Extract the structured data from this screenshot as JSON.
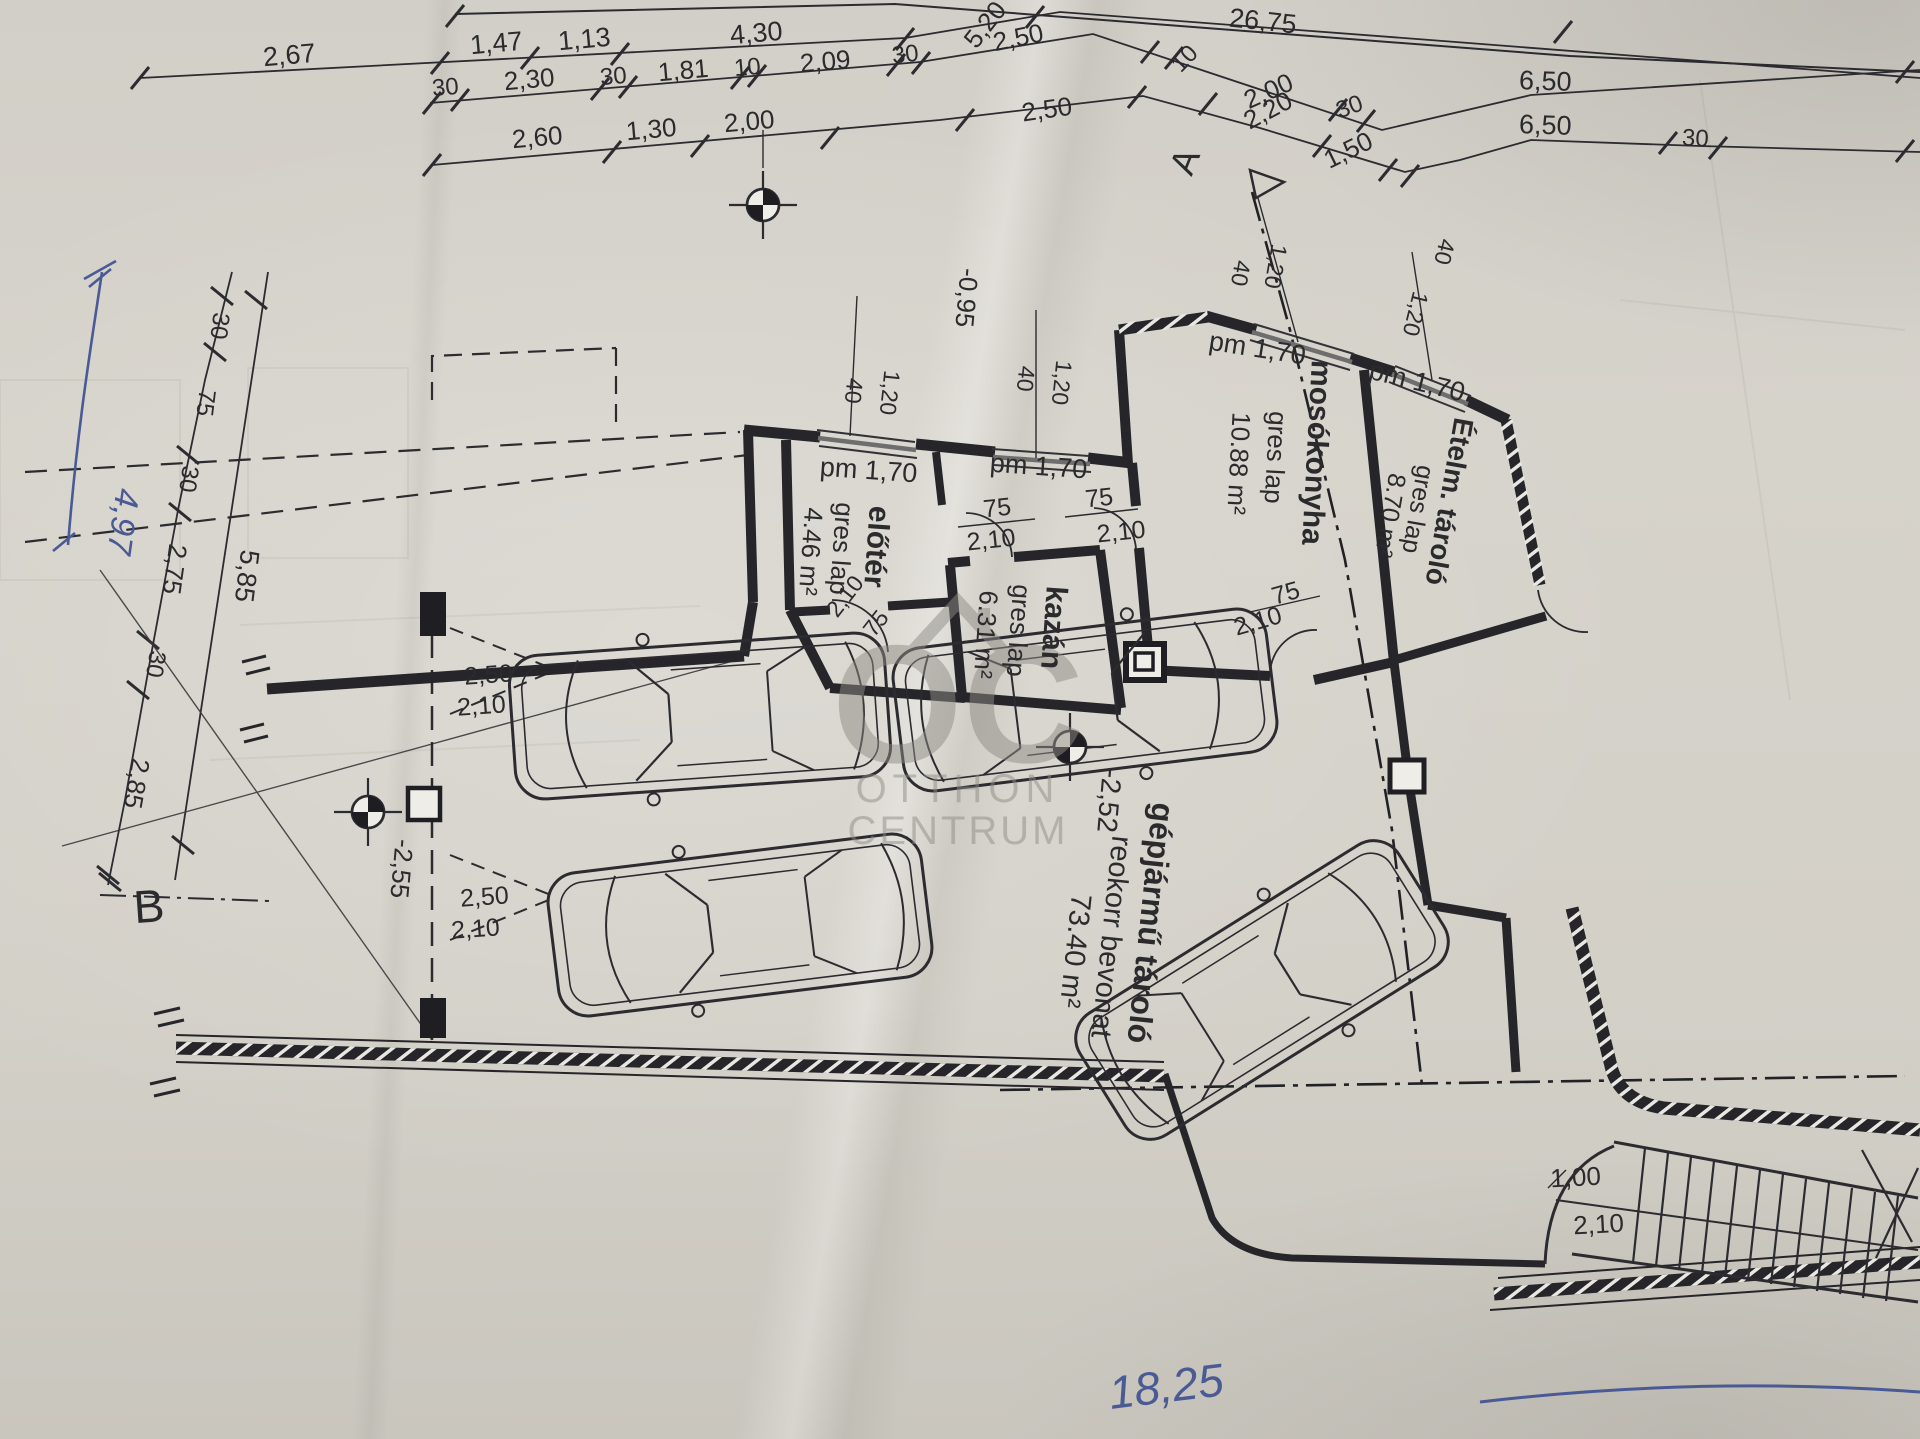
{
  "colors": {
    "ink": "#2b2b2e",
    "pen": "#4a5a95",
    "watermark": "#8e8c85",
    "paper": "#d4d1ca",
    "wall": "#26262a",
    "window_center": "#6e6e6e"
  },
  "watermark": {
    "logo": "OC",
    "name_line1": "OTTHON",
    "name_line2": "CENTRUM"
  },
  "rooms": [
    {
      "name": "előtér",
      "finish": "gres lap",
      "area": "4.46 m²"
    },
    {
      "name": "mosókonyha",
      "finish": "gres lap",
      "area": "10.88 m²"
    },
    {
      "name": "Ételm. tároló",
      "finish": "gres lap",
      "area": "8.70 m²"
    },
    {
      "name": "kazán",
      "finish": "gres lap",
      "area": "6.31 m²"
    },
    {
      "name": "gépjármű tároló",
      "finish": "reokorr bevonat",
      "area": "73.40 m²"
    }
  ],
  "elevation_markers": [
    "-0,95",
    "-2,52",
    "-2,55"
  ],
  "section_markers": [
    "A",
    "B"
  ],
  "stair_dims": [
    "1,00",
    "2,10"
  ],
  "handwritten_notes": [
    "4,97",
    "18,25"
  ],
  "window_labels": [
    "pm 1,70",
    "40",
    "1,20"
  ],
  "door_size_labels": [
    "75",
    "2,10",
    "2,50"
  ],
  "labels": [
    {
      "t": "2,67",
      "x": 290,
      "y": 64,
      "r": -5,
      "s": 27
    },
    {
      "t": "1,47",
      "x": 497,
      "y": 52,
      "r": -5,
      "s": 27
    },
    {
      "t": "1,13",
      "x": 585,
      "y": 48,
      "r": -5,
      "s": 27
    },
    {
      "t": "4,30",
      "x": 757,
      "y": 42,
      "r": -5,
      "s": 27
    },
    {
      "t": "5,20",
      "x": 992,
      "y": 30,
      "r": -52,
      "s": 26
    },
    {
      "t": "26,75",
      "x": 1262,
      "y": 30,
      "r": 6,
      "s": 27
    },
    {
      "t": "30",
      "x": 446,
      "y": 95,
      "r": -5,
      "s": 24
    },
    {
      "t": "2,30",
      "x": 530,
      "y": 88,
      "r": -5,
      "s": 26
    },
    {
      "t": "30",
      "x": 614,
      "y": 84,
      "r": -5,
      "s": 24
    },
    {
      "t": "1,81",
      "x": 684,
      "y": 79,
      "r": -5,
      "s": 26
    },
    {
      "t": "10",
      "x": 748,
      "y": 75,
      "r": -5,
      "s": 24
    },
    {
      "t": "2,09",
      "x": 826,
      "y": 70,
      "r": -5,
      "s": 26
    },
    {
      "t": "30",
      "x": 906,
      "y": 62,
      "r": -6,
      "s": 24
    },
    {
      "t": "2,50",
      "x": 1020,
      "y": 46,
      "r": -12,
      "s": 26
    },
    {
      "t": "10",
      "x": 1190,
      "y": 64,
      "r": -46,
      "s": 24
    },
    {
      "t": "2,00",
      "x": 1272,
      "y": 99,
      "r": -24,
      "s": 26
    },
    {
      "t": "30",
      "x": 1352,
      "y": 114,
      "r": -20,
      "s": 24
    },
    {
      "t": "6,50",
      "x": 1545,
      "y": 90,
      "r": 2,
      "s": 27
    },
    {
      "t": "2,60",
      "x": 538,
      "y": 146,
      "r": -5,
      "s": 26
    },
    {
      "t": "1,30",
      "x": 652,
      "y": 138,
      "r": -5,
      "s": 26
    },
    {
      "t": "2,00",
      "x": 750,
      "y": 130,
      "r": -5,
      "s": 26
    },
    {
      "t": "2,50",
      "x": 1048,
      "y": 118,
      "r": -8,
      "s": 26
    },
    {
      "t": "2,20",
      "x": 1272,
      "y": 118,
      "r": -28,
      "s": 26
    },
    {
      "t": "1,50",
      "x": 1352,
      "y": 158,
      "r": -26,
      "s": 26
    },
    {
      "t": "6,50",
      "x": 1545,
      "y": 134,
      "r": 2,
      "s": 27
    },
    {
      "t": "30",
      "x": 1695,
      "y": 146,
      "r": 3,
      "s": 24
    },
    {
      "t": "A",
      "x": 1196,
      "y": 166,
      "r": -68,
      "s": 36
    },
    {
      "t": "30",
      "x": 212,
      "y": 325,
      "r": 97,
      "s": 24
    },
    {
      "t": "75",
      "x": 198,
      "y": 402,
      "r": 97,
      "s": 24
    },
    {
      "t": "30",
      "x": 181,
      "y": 478,
      "r": 98,
      "s": 24
    },
    {
      "t": "2,75",
      "x": 166,
      "y": 568,
      "r": 98,
      "s": 26
    },
    {
      "t": "5,85",
      "x": 238,
      "y": 575,
      "r": 97,
      "s": 27
    },
    {
      "t": "30",
      "x": 148,
      "y": 663,
      "r": 99,
      "s": 24
    },
    {
      "t": "2,85",
      "x": 128,
      "y": 782,
      "r": 100,
      "s": 26
    },
    {
      "t": "B",
      "x": 150,
      "y": 922,
      "r": -4,
      "s": 46
    },
    {
      "t": "4,97",
      "x": 112,
      "y": 520,
      "r": 98,
      "s": 34,
      "hand": true
    },
    {
      "t": "40",
      "x": 846,
      "y": 390,
      "r": 96,
      "s": 23
    },
    {
      "t": "1,20",
      "x": 882,
      "y": 392,
      "r": 96,
      "s": 23
    },
    {
      "t": "40",
      "x": 1018,
      "y": 378,
      "r": 96,
      "s": 23
    },
    {
      "t": "1,20",
      "x": 1054,
      "y": 382,
      "r": 96,
      "s": 23
    },
    {
      "t": "40",
      "x": 1233,
      "y": 272,
      "r": 100,
      "s": 23
    },
    {
      "t": "1,20",
      "x": 1268,
      "y": 265,
      "r": 100,
      "s": 23
    },
    {
      "t": "40",
      "x": 1437,
      "y": 250,
      "r": 104,
      "s": 23
    },
    {
      "t": "1,20",
      "x": 1408,
      "y": 312,
      "r": 104,
      "s": 23
    },
    {
      "t": "pm 1,70",
      "x": 868,
      "y": 479,
      "r": 4,
      "s": 27
    },
    {
      "t": "pm 1,70",
      "x": 1038,
      "y": 475,
      "r": 4,
      "s": 27
    },
    {
      "t": "pm 1,70",
      "x": 1256,
      "y": 357,
      "r": 9,
      "s": 27
    },
    {
      "t": "pm 1,70",
      "x": 1415,
      "y": 390,
      "r": 14,
      "s": 27
    },
    {
      "t": "75",
      "x": 998,
      "y": 516,
      "r": -6,
      "s": 25
    },
    {
      "t": "2,10",
      "x": 992,
      "y": 548,
      "r": -6,
      "s": 25
    },
    {
      "t": "75",
      "x": 1100,
      "y": 506,
      "r": -6,
      "s": 25
    },
    {
      "t": "2,10",
      "x": 1122,
      "y": 540,
      "r": -6,
      "s": 25
    },
    {
      "t": "2,10",
      "x": 851,
      "y": 601,
      "r": -52,
      "s": 23
    },
    {
      "t": "75",
      "x": 882,
      "y": 628,
      "r": -52,
      "s": 23
    },
    {
      "t": "75",
      "x": 1288,
      "y": 601,
      "r": -16,
      "s": 25
    },
    {
      "t": "2,10",
      "x": 1260,
      "y": 629,
      "r": -16,
      "s": 25
    },
    {
      "t": "előtér",
      "x": 867,
      "y": 546,
      "r": 94,
      "s": 30,
      "b": 1
    },
    {
      "t": "gres lap",
      "x": 833,
      "y": 548,
      "r": 94,
      "s": 26
    },
    {
      "t": "4.46 m²",
      "x": 802,
      "y": 551,
      "r": 94,
      "s": 26
    },
    {
      "t": "mosókonyha",
      "x": 1307,
      "y": 452,
      "r": 93,
      "s": 30,
      "b": 1
    },
    {
      "t": "gres lap",
      "x": 1267,
      "y": 457,
      "r": 93,
      "s": 26
    },
    {
      "t": "10.88 m²",
      "x": 1230,
      "y": 463,
      "r": 93,
      "s": 26
    },
    {
      "t": "Ételm. tároló",
      "x": 1440,
      "y": 500,
      "r": 100,
      "s": 28,
      "b": 1
    },
    {
      "t": "gres lap",
      "x": 1410,
      "y": 508,
      "r": 100,
      "s": 25
    },
    {
      "t": "8.70 m²",
      "x": 1382,
      "y": 514,
      "r": 100,
      "s": 25
    },
    {
      "t": "kazán",
      "x": 1044,
      "y": 627,
      "r": 94,
      "s": 30,
      "b": 1
    },
    {
      "t": "gres lap",
      "x": 1010,
      "y": 630,
      "r": 94,
      "s": 26
    },
    {
      "t": "6.31 m²",
      "x": 977,
      "y": 634,
      "r": 94,
      "s": 26
    },
    {
      "t": "gépjármű tároló",
      "x": 1140,
      "y": 922,
      "r": 96,
      "s": 32,
      "b": 1
    },
    {
      "t": "reokorr bevonat",
      "x": 1102,
      "y": 936,
      "r": 96,
      "s": 29
    },
    {
      "t": "73.40 m²",
      "x": 1066,
      "y": 950,
      "r": 96,
      "s": 29
    },
    {
      "t": "2,50",
      "x": 489,
      "y": 683,
      "r": -4,
      "s": 25
    },
    {
      "t": "2,10",
      "x": 482,
      "y": 714,
      "r": -4,
      "s": 25
    },
    {
      "t": "2,50",
      "x": 485,
      "y": 905,
      "r": -4,
      "s": 25
    },
    {
      "t": "2,10",
      "x": 476,
      "y": 937,
      "r": -4,
      "s": 25
    },
    {
      "t": "1,00",
      "x": 1576,
      "y": 1186,
      "r": -3,
      "s": 26
    },
    {
      "t": "2,10",
      "x": 1599,
      "y": 1233,
      "r": -3,
      "s": 26
    },
    {
      "t": "-0,95",
      "x": 958,
      "y": 297,
      "r": 95,
      "s": 26
    },
    {
      "t": "-2,52",
      "x": 1100,
      "y": 800,
      "r": 95,
      "s": 28
    },
    {
      "t": "-2,55",
      "x": 393,
      "y": 868,
      "r": 95,
      "s": 26
    },
    {
      "t": "18,25",
      "x": 1168,
      "y": 1402,
      "r": -7,
      "s": 46,
      "hand": true
    }
  ]
}
